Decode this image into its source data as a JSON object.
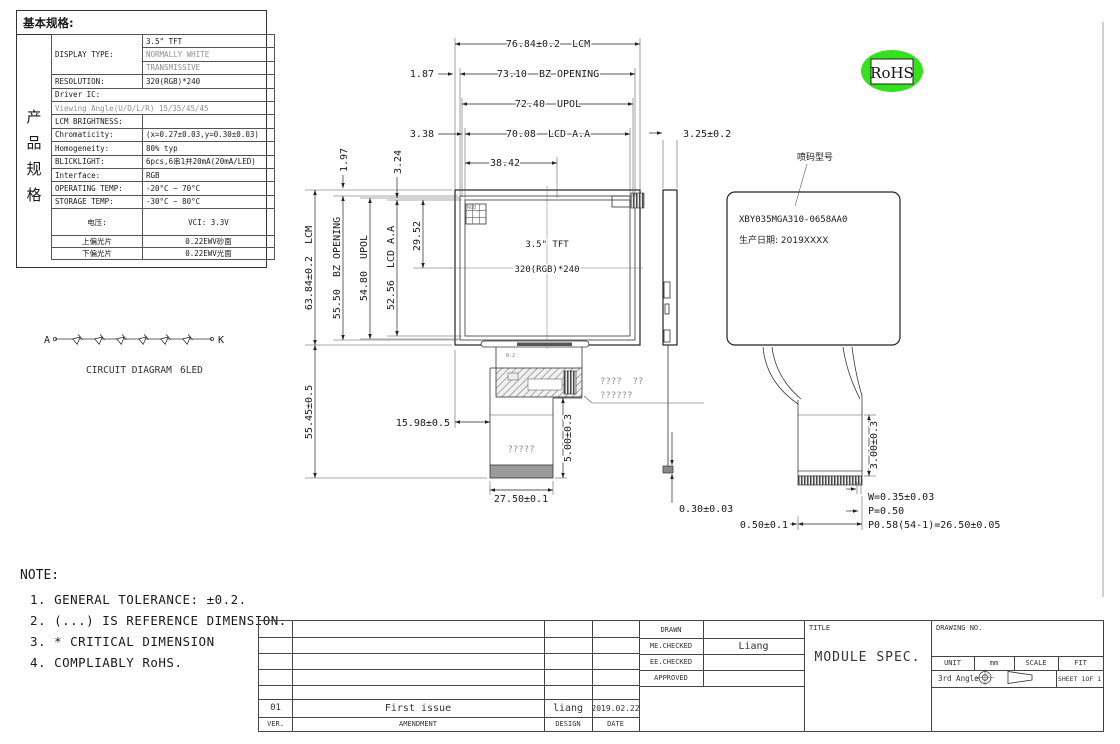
{
  "spec": {
    "title": "基本规格:",
    "side_label": [
      "产",
      "品",
      "规",
      "格"
    ],
    "rows": [
      {
        "label": "DISPLAY TYPE:",
        "value": "3.5\" TFT"
      },
      {
        "label": "",
        "value": "NORMALLY WHITE",
        "muted": true
      },
      {
        "label": "",
        "value": "TRANSMISSIVE",
        "muted": true
      },
      {
        "label": "RESOLUTION:",
        "value": "320(RGB)*240"
      },
      {
        "label": "Driver IC:",
        "value": "",
        "full": true
      },
      {
        "label": "Viewing Angle(U/D/L/R)",
        "value": "15/35/45/45",
        "full": true,
        "muted": true
      },
      {
        "label": "LCM BRIGHTNESS:",
        "value": ""
      },
      {
        "label": "Chromaticity:",
        "value": "(x=0.27±0.03,y=0.30±0.03)"
      },
      {
        "label": "Homogeneity:",
        "value": "80% typ"
      },
      {
        "label": "BLICKLIGHT:",
        "value": "6pcs,6串1并20mA(20mA/LED)"
      },
      {
        "label": "Interface:",
        "value": "RGB"
      },
      {
        "label": "OPERATING TEMP:",
        "value": "-20°C ~ 70°C"
      },
      {
        "label": "STORAGE TEMP:",
        "value": "-30°C ~ 80°C"
      },
      {
        "label": "电压:",
        "value": "VCI: 3.3V",
        "center": true
      },
      {
        "label": "上偏光片",
        "value": "0.22EWV砂面",
        "center": true
      },
      {
        "label": "下偏光片",
        "value": "0.22EWV光面",
        "center": true
      }
    ]
  },
  "circuit": {
    "anode": "A",
    "cathode": "K",
    "caption": "CIRCUIT DIAGRAM",
    "caption_suffix": "6LED"
  },
  "front": {
    "line1": "3.5\" TFT",
    "line2": "320(RGB)*240",
    "corner_mark": "RGB",
    "bar_mark": "0.2",
    "tail_text": "?????"
  },
  "dims": {
    "lcm_w": "76.84±0.2  LCM",
    "bz_w_off": "1.87",
    "bz_w": "73.10  BZ OPENING",
    "upol_w": "72.40  UPOL",
    "aa_w_off": "3.38",
    "aa_w": "70.08  LCD A.A",
    "half_w": "38.42",
    "lcm_h": "63.84±0.2  LCM",
    "bz_h": "55.50  BZ OPENING",
    "upol_h": "54.80  UPOL",
    "aa_h": "52.56  LCD A.A",
    "half_h": "29.52",
    "bz_h_off": "1.97",
    "aa_h_off": "3.24",
    "tail_h": "55.45±0.5",
    "tail_x": "15.98±0.5",
    "tail_seg": "5.00±0.3",
    "tail_w": "27.50±0.1",
    "side_t": "3.25±0.2",
    "side_tip": "0.30±0.03",
    "pin_margin": "0.50±0.1",
    "conn_h": "3.00±0.3",
    "pin_w": "W=0.35±0.03",
    "pin_p": "P=0.50",
    "pin_total": "P0.58(54-1)=26.50±0.05"
  },
  "fpc_note": {
    "line1": "????  ??",
    "line2": "??????"
  },
  "back": {
    "callout": "喷码型号",
    "model": "XBY035MGA310-0658AA0",
    "date_line": "生产日期: 2019XXXX"
  },
  "rohs": {
    "label": "RoHS",
    "color": "#35e01c"
  },
  "pins": {
    "headers": [
      "NO.",
      "PIN NAME"
    ],
    "rows": [
      [
        "1",
        "LED-"
      ],
      [
        "2",
        "LED-"
      ],
      [
        "3",
        "LED+"
      ],
      [
        "4",
        "LED+"
      ],
      [
        "5",
        "NC(YU)"
      ],
      [
        "6",
        "NC(XR)"
      ],
      [
        "7",
        "NC"
      ],
      [
        "8",
        "RESET"
      ],
      [
        "9",
        "CS"
      ],
      [
        "10",
        "SCK"
      ],
      [
        "11",
        "SDI"
      ],
      [
        "12",
        "B0"
      ],
      [
        "13",
        "B1"
      ],
      [
        "14",
        "B2"
      ],
      [
        "15",
        "B3"
      ],
      [
        "16",
        "B4"
      ],
      [
        "17",
        "B5"
      ],
      [
        "18",
        "B6"
      ],
      [
        "19",
        "B7"
      ],
      [
        "20",
        "G0"
      ],
      [
        "21",
        "G1"
      ],
      [
        "22",
        "G2"
      ],
      [
        "23",
        "G3"
      ],
      [
        "24",
        "G4"
      ],
      [
        "25",
        "G5"
      ],
      [
        "26",
        "G6"
      ],
      [
        "27",
        "G7"
      ],
      [
        "28",
        "R0"
      ],
      [
        "29",
        "R1"
      ],
      [
        "30",
        "R2"
      ],
      [
        "31",
        "R3"
      ],
      [
        "32",
        "R4"
      ],
      [
        "33",
        "R5"
      ],
      [
        "34",
        "R6"
      ],
      [
        "35",
        "R7"
      ],
      [
        "36",
        "HSYNC"
      ],
      [
        "37",
        "VSYNC"
      ],
      [
        "38",
        "DOTCLK"
      ],
      [
        "39",
        "NC"
      ],
      [
        "40",
        "NC"
      ],
      [
        "41",
        "VDDIO"
      ],
      [
        "42",
        "VDD"
      ],
      [
        "43",
        "NC(YD)"
      ],
      [
        "44",
        "NC(XL)"
      ],
      [
        "45",
        "NC(VGL)"
      ],
      [
        "46",
        "NC"
      ],
      [
        "47",
        "NC(VGH)"
      ],
      [
        "48",
        "SEL2"
      ],
      [
        "49",
        "SEL1"
      ],
      [
        "50",
        "SEL0"
      ],
      [
        "51",
        "NC"
      ],
      [
        "52",
        "DEN"
      ],
      [
        "53",
        "GND"
      ],
      [
        "54",
        "GND"
      ]
    ]
  },
  "notes": {
    "heading": "NOTE:",
    "items": [
      "1. GENERAL TOLERANCE: ±0.2.",
      "2. (...) IS REFERENCE DIMENSION.",
      "3. * CRITICAL DIMENSION",
      "4. COMPLIABLY RoHS."
    ]
  },
  "tb": {
    "drawn": "DRAWN",
    "me_checked": "ME.CHECKED",
    "ee_checked": "EE.CHECKED",
    "approved": "APPROVED",
    "checked_by": "Liang",
    "title_label": "TITLE",
    "title": "MODULE SPEC.",
    "drawing_no_label": "DRAWING NO.",
    "unit_label": "UNIT",
    "unit": "mm",
    "scale_label": "SCALE",
    "scale": "FIT",
    "angle": "3rd Angle",
    "sheet_label": "SHEET",
    "sheet": "1OF 1",
    "ver": "01",
    "amendment": "First issue",
    "design": "liang",
    "date": "2019.02.22",
    "ver_label": "VER.",
    "amendment_label": "AMENDMENT",
    "design_label": "DESIGN",
    "date_label": "DATE"
  }
}
